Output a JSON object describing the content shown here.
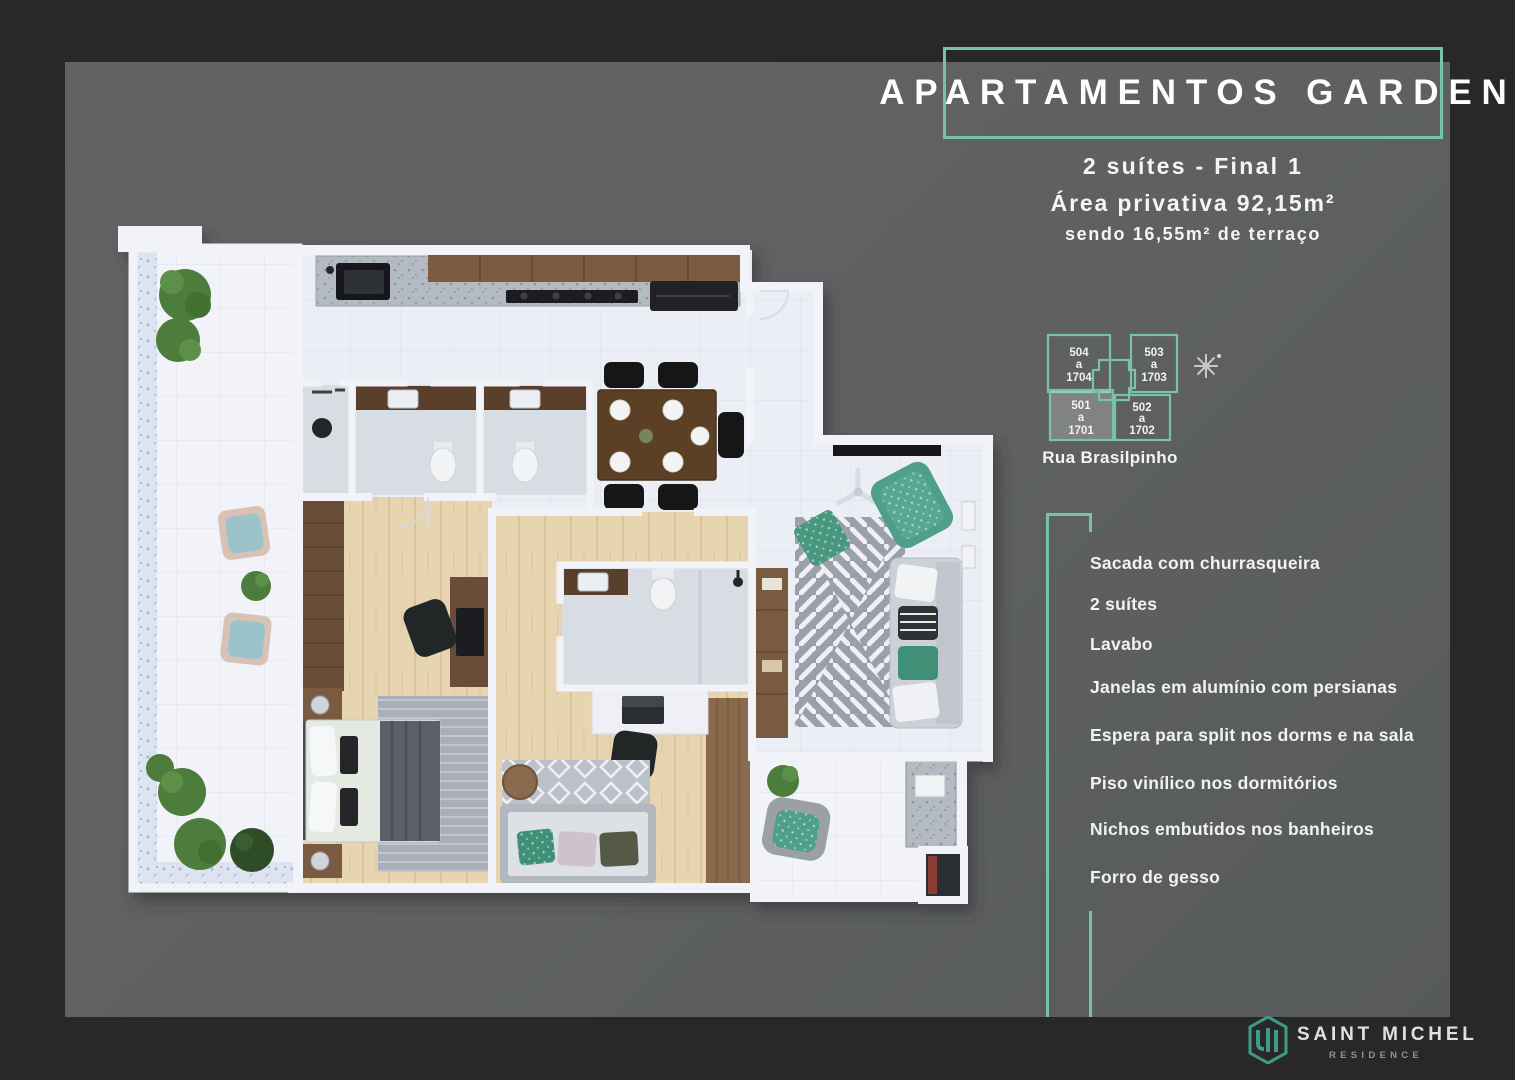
{
  "palette": {
    "accent_teal": "#79c2aa",
    "logo_teal": "#3f9c84",
    "frame_dark": "#282828",
    "panel_gray": "#5e6062",
    "text_white": "#f5f5f3"
  },
  "header": {
    "title": "APARTAMENTOS GARDEN",
    "subtitle_line1": "2 suítes - Final 1",
    "subtitle_line2": "Área privativa 92,15m²",
    "subtitle_line3": "sendo 16,55m² de terraço"
  },
  "location_map": {
    "street": "Rua Brasilpinho",
    "compass_icon": "compass-rose",
    "units": [
      {
        "num": "504",
        "sep": "a",
        "floor": "1704",
        "highlighted": false
      },
      {
        "num": "503",
        "sep": "a",
        "floor": "1703",
        "highlighted": false
      },
      {
        "num": "501",
        "sep": "a",
        "floor": "1701",
        "highlighted": true
      },
      {
        "num": "502",
        "sep": "a",
        "floor": "1702",
        "highlighted": false
      }
    ]
  },
  "features": {
    "items": [
      "Sacada com churrasqueira",
      "2 suítes",
      "Lavabo",
      "Janelas em alumínio com persianas",
      "Espera para split nos dorms e na sala",
      "Piso vinílico nos dormitórios",
      "Nichos embutidos nos banheiros",
      "Forro de gesso"
    ]
  },
  "logo": {
    "name": "SAINT MICHEL",
    "subname": "RESIDENCE",
    "icon": "saint-michel-building-icon"
  }
}
